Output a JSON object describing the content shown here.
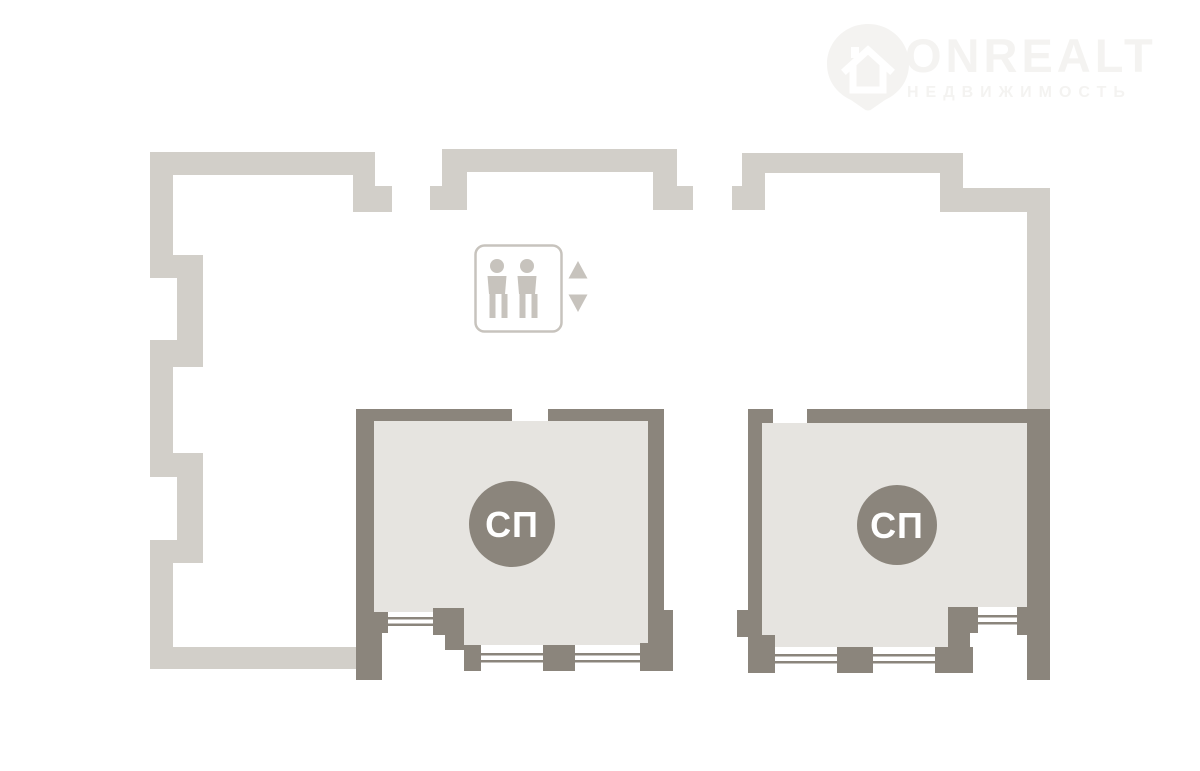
{
  "watermark": {
    "brand": "ONREALT",
    "tagline": "НЕДВИЖИМОСТЬ"
  },
  "rooms": {
    "left": {
      "label": "СП"
    },
    "right": {
      "label": "СП"
    }
  },
  "colors": {
    "background": "#ffffff",
    "outer_wall": "#d2cfc9",
    "room_wall": "#8b857c",
    "room_fill": "#e6e4e0",
    "elevator_icon": "#c7c3bd",
    "watermark": "#f4f3f1",
    "badge_text": "#ffffff"
  }
}
